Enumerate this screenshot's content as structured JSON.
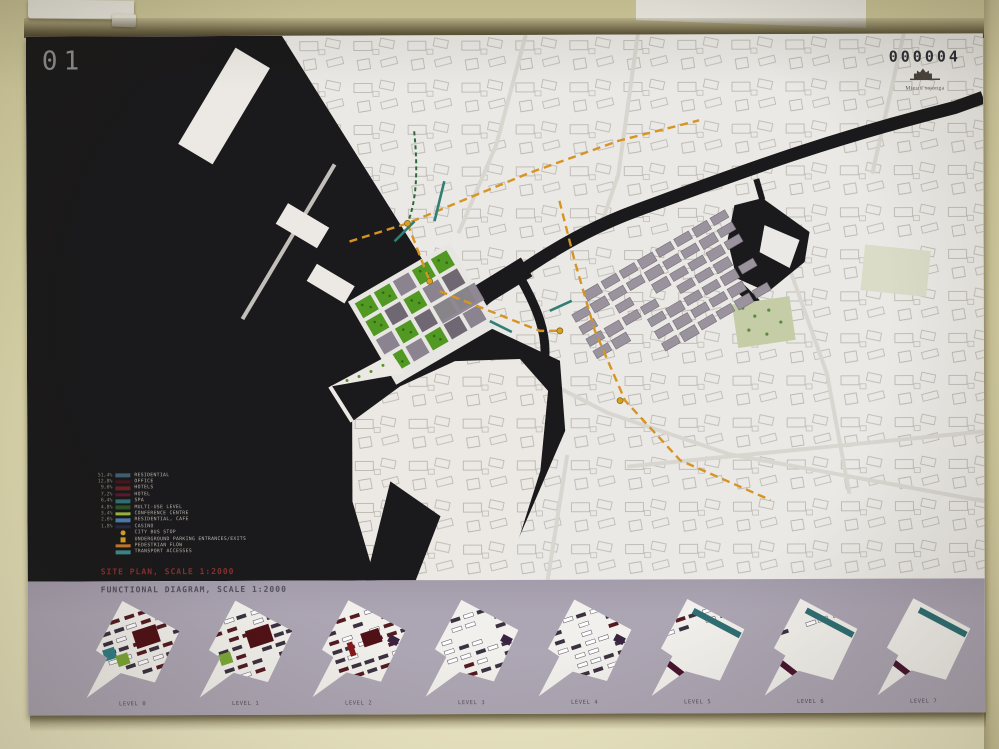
{
  "board": {
    "number": "01",
    "entry_number": "000004",
    "stamp_text": "Miestu sajunga",
    "captions": {
      "site_plan": "SITE PLAN, SCALE 1:2000",
      "functional": "FUNCTIONAL DIAGRAM, SCALE 1:2000"
    },
    "legend": {
      "items": [
        {
          "pct": "51,4%",
          "swatch": "#3e5f6e",
          "label": "RESIDENTIAL"
        },
        {
          "pct": "12,8%",
          "swatch": "#4a161c",
          "label": "OFFICE"
        },
        {
          "pct": "9,6%",
          "swatch": "#6e2024",
          "label": "HOTELS"
        },
        {
          "pct": "7,2%",
          "swatch": "#5a1a2e",
          "label": "HOTEL"
        },
        {
          "pct": "6,4%",
          "swatch": "#2e6f74",
          "label": "SPA"
        },
        {
          "pct": "4,8%",
          "swatch": "#2a5326",
          "label": "MULTI-USE LEVEL"
        },
        {
          "pct": "3,4%",
          "swatch": "#9ab83a",
          "label": "CONFERENCE CENTRE"
        },
        {
          "pct": "2,6%",
          "swatch": "#4a7ab0",
          "label": "RESIDENTIAL, CAFE"
        },
        {
          "pct": "1,8%",
          "swatch": "#232a44",
          "label": "CASINO"
        },
        {
          "pct": "",
          "swatch": "#d8a020",
          "icon": "bus-stop",
          "label": "CITY BUS STOP"
        },
        {
          "pct": "",
          "swatch": "#d8a020",
          "icon": "parking",
          "label": "UNDERGROUND PARKING ENTRANCES/EXITS"
        },
        {
          "pct": "",
          "swatch": "#c87828",
          "label": "PEDESTRIAN FLOW"
        },
        {
          "pct": "",
          "swatch": "#3a8a8a",
          "label": "TRANSPORT ACCESSES"
        }
      ]
    },
    "levels": [
      {
        "label": "LEVEL 0",
        "density": 3,
        "big": 2,
        "teal_sq": true,
        "green_sq": true
      },
      {
        "label": "LEVEL 1",
        "density": 3,
        "big": 2,
        "green_sq": true
      },
      {
        "label": "LEVEL 2",
        "density": 3,
        "big": 1,
        "red_bar": true,
        "nub": true
      },
      {
        "label": "LEVEL 3",
        "density": 2,
        "nub": true
      },
      {
        "label": "LEVEL 4",
        "density": 2,
        "nub": true
      },
      {
        "label": "LEVEL 5",
        "density": 1,
        "teal_bar": true,
        "maroon_bar": true
      },
      {
        "label": "LEVEL 6",
        "density": 1,
        "teal_bar": true,
        "maroon_bar": true
      },
      {
        "label": "LEVEL 7",
        "density": 0,
        "teal_bar": true,
        "maroon_bar": true
      }
    ],
    "colors": {
      "water": "#1a191b",
      "land": "#ebe9e5",
      "site_green": "#4f9a1e",
      "site_gray": "#8b8490",
      "route_orange": "#d8941f",
      "flow_teal": "#2e7f74",
      "strip_lavender": "#aca5b3",
      "bar_dark": "#3b3140",
      "bar_maroon": "#551a22",
      "block_maroon": "#521016",
      "long_teal": "#2d6f74",
      "long_maroon": "#4a1430"
    }
  }
}
